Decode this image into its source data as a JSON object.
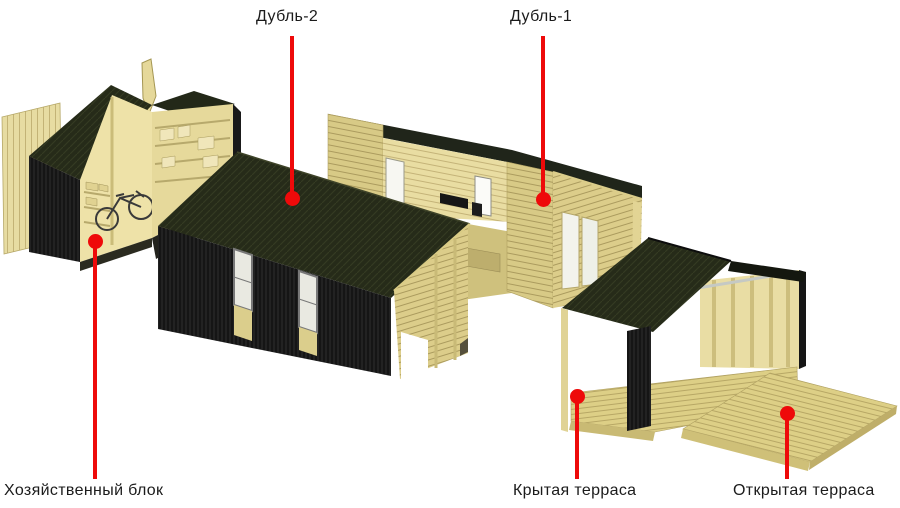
{
  "callouts": {
    "dubl2": {
      "label": "Дубль-2"
    },
    "dubl1": {
      "label": "Дубль-1"
    },
    "utility": {
      "label": "Хозяйственный блок"
    },
    "covered": {
      "label": "Крытая терраса"
    },
    "open": {
      "label": "Открытая терраса"
    }
  },
  "colors": {
    "callout_red": "#ee0a0a",
    "label_text": "#1b1b1b",
    "background": "#ffffff",
    "cladding_black": "#151515",
    "roof_dark_olive": "#262b19",
    "wood_tan": "#d8ca86"
  }
}
